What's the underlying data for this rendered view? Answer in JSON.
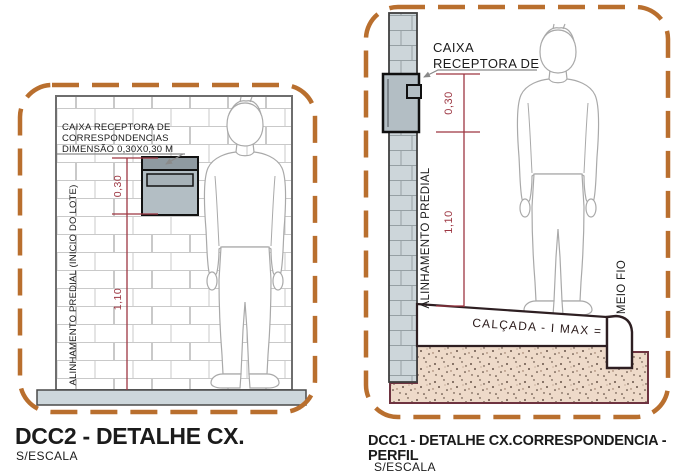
{
  "colors": {
    "dashed_border": "#b96f2e",
    "dimension_red": "#9d3642",
    "leader_gray": "#8a8a8a",
    "soil_fill": "#eedac9",
    "soil_border": "#6e3340",
    "box_gray": "#b3bec4",
    "slab_gray": "#cdd7dc"
  },
  "panel_front": {
    "box_label": {
      "line1": "CAIXA RECEPTORA DE",
      "line2": "CORRESPONDENCIAS",
      "line3": "DIMENSÃO 0,30X0,30 M"
    },
    "alignment_label": "ALINHAMENTO PREDIAL (INICIO DO LOTE)",
    "dim_box_height": "0,30",
    "dim_mount_height": "1,10",
    "title": "DCC2 - DETALHE CX.",
    "scale_note": "S/ESCALA"
  },
  "panel_profile": {
    "box_label": {
      "line1": "CAIXA",
      "line2": "RECEPTORA DE"
    },
    "alignment_label": "ALINHAMENTO PREDIAL",
    "dim_box_height": "0,30",
    "dim_mount_height": "1,10",
    "sidewalk_label": "CALÇADA - I MAX =",
    "curb_label": "MEIO FIO",
    "title_line1": "DCC1 - DETALHE CX.CORRESPONDENCIA -",
    "title_line2": "PERFIL",
    "scale_note": "S/ESCALA"
  }
}
